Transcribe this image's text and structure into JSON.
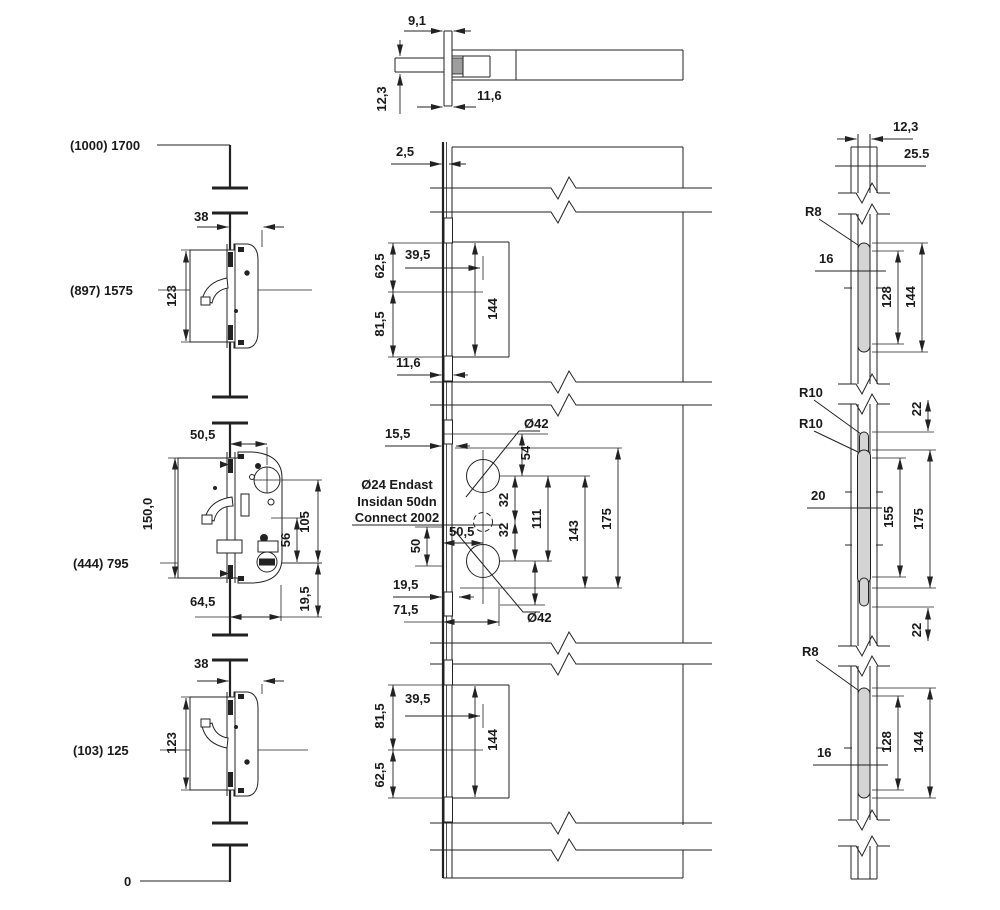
{
  "drawing": {
    "top_view": {
      "d91": "9,1",
      "d123": "12,3",
      "d116": "11,6"
    },
    "chain": {
      "t1700": "(1000) 1700",
      "t1575": "(897) 1575",
      "t795": "(444) 795",
      "t125": "(103) 125",
      "t0": "0"
    },
    "hook_top": {
      "d38": "38",
      "d123": "123"
    },
    "main_lock": {
      "d505": "50,5",
      "d150": "150,0",
      "d645": "64,5",
      "d56": "56",
      "d105": "105",
      "d195": "19,5"
    },
    "plate_top": {
      "d25": "2,5",
      "d625": "62,5",
      "d395": "39,5",
      "d815": "81,5",
      "d144": "144",
      "d116": "11,6"
    },
    "plate_mid": {
      "d155": "15,5",
      "dia_top": "Ø42",
      "dia_bot": "Ø42",
      "note1": "Ø24 Endast",
      "note2": "Insidan 50dn",
      "note3": "Connect 2002",
      "d54t": "54",
      "d32a": "32",
      "d32b": "32",
      "d111": "111",
      "d143": "143",
      "d175": "175",
      "d50": "50",
      "d505": "50,5",
      "d195": "19,5",
      "d715": "71,5"
    },
    "plate_bot": {
      "d815": "81,5",
      "d395": "39,5",
      "d625": "62,5",
      "d144": "144"
    },
    "hook_bot": {
      "d38": "38",
      "d123": "123"
    },
    "strike_top": {
      "d123": "12,3",
      "d255": "25.5",
      "r8": "R8",
      "d16": "16",
      "d128": "128",
      "d144": "144"
    },
    "strike_mid": {
      "r10a": "R10",
      "r10b": "R10",
      "d22t": "22",
      "d20": "20",
      "d155": "155",
      "d175": "175",
      "d22b": "22"
    },
    "strike_bot": {
      "r8": "R8",
      "d16": "16",
      "d128": "128",
      "d144": "144"
    }
  }
}
